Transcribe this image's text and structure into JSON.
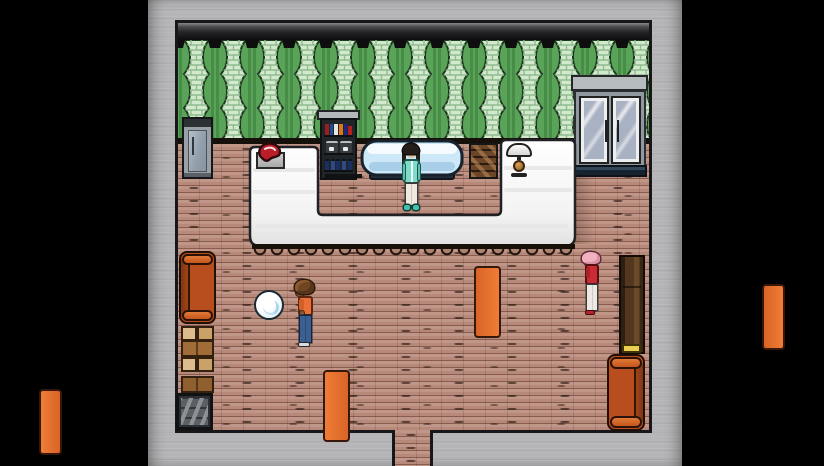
{
  "viewport": {
    "width": 824,
    "height": 466,
    "letterbox_color": "#000000"
  },
  "scene_type": "top-down RPG shop interior",
  "palette": {
    "surround_gray": "#b5b5b7",
    "outline_dark": "#17171a",
    "wall_trim_dark": "#232325",
    "curtain_green": "#5aa45a",
    "brick_column_light": "#d3e9cd",
    "floor_brick": "#b7897a",
    "counter_white": "#f7f7f7",
    "basin_water_blue": "#cfe9f8",
    "couch_orange": "#cf5d23",
    "wardrobe_brown": "#53381f",
    "box_tan": "#dcbc8c",
    "crate_gray": "#5c6064",
    "door_glass": "#a9b2c2",
    "scale_gold": "#b97e33",
    "meat_red": "#bb1e28",
    "orb_white": "#f4fafd"
  },
  "characters": [
    {
      "id": "shopkeeper",
      "hair": "#241d18",
      "jacket": "#7edbca",
      "pants": "#efe9df",
      "shoes": "#3fc3b0",
      "position": "behind service counter, facing forward"
    },
    {
      "id": "visitor-orange-shirt",
      "hair": "#6f4522",
      "shirt": "#ea7038",
      "jeans": "#3c5f91",
      "position": "center floor, facing white orb"
    },
    {
      "id": "visitor-pink-hair",
      "hair": "#f0b2c0",
      "jacket": "#cb2c34",
      "pants": "#ece9e4",
      "position": "right side near wardrobe, facing left"
    }
  ],
  "objects": [
    {
      "id": "refrigerator",
      "location": "back wall left"
    },
    {
      "id": "beverage-shelf",
      "contents": [
        "books",
        "coffee machines",
        "bottles"
      ],
      "location": "back wall center-left"
    },
    {
      "id": "wall-basin",
      "location": "back wall behind shopkeeper"
    },
    {
      "id": "wood-pallet",
      "location": "back wall right of basin"
    },
    {
      "id": "service-counter",
      "shape": "U-shaped white counter"
    },
    {
      "id": "meat-on-tray",
      "location": "left counter top"
    },
    {
      "id": "counter-scale",
      "location": "right counter top"
    },
    {
      "id": "double-glass-door",
      "location": "top right wall"
    },
    {
      "id": "couch-left",
      "location": "left wall upper"
    },
    {
      "id": "cardboard-box-stack-1",
      "location": "left wall middle"
    },
    {
      "id": "cardboard-box-stack-2",
      "location": "left wall lower"
    },
    {
      "id": "gray-slat-crate",
      "location": "bottom left corner"
    },
    {
      "id": "wardrobe",
      "detail": "yellow item at base",
      "location": "right wall"
    },
    {
      "id": "couch-right",
      "location": "bottom right corner"
    },
    {
      "id": "white-orb",
      "location": "center floor"
    },
    {
      "id": "south-exit",
      "location": "bottom center doorway"
    }
  ]
}
